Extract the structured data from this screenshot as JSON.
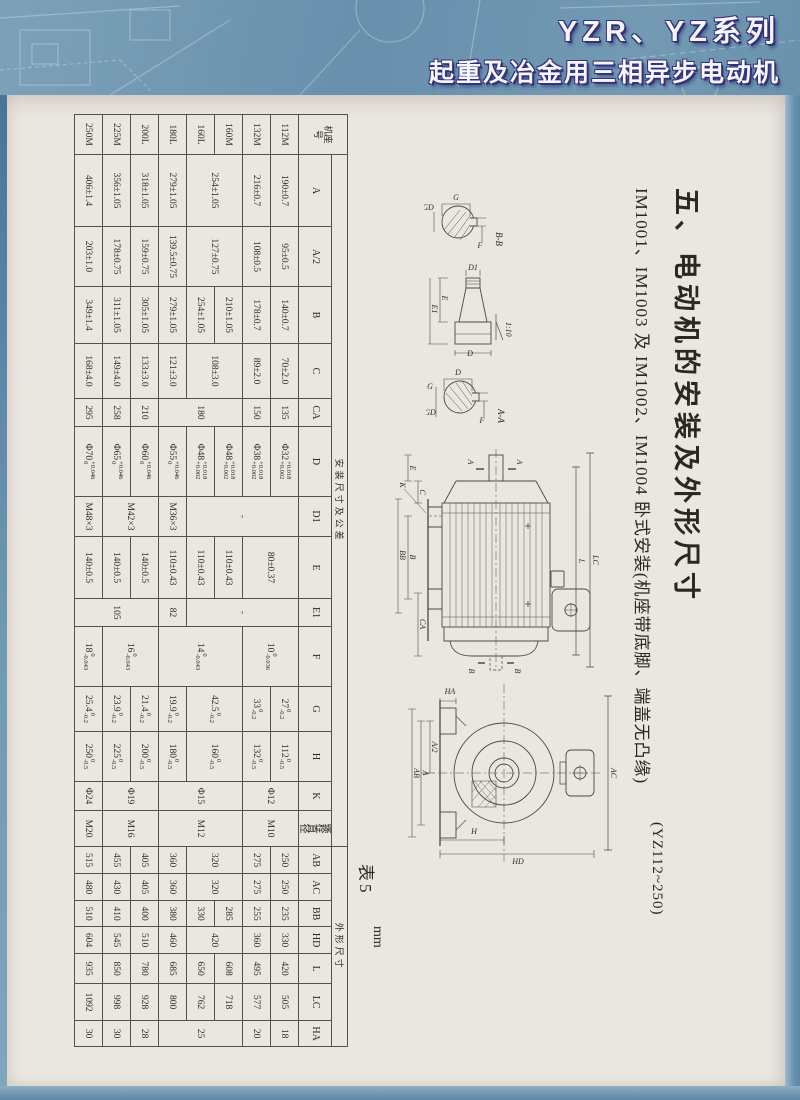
{
  "header": {
    "line1": "YZR、YZ系列",
    "line2": "起重及冶金用三相异步电动机"
  },
  "section": {
    "title": "五、电动机的安装及外形尺寸",
    "subtitle": "IM1001、IM1003 及 IM1002、IM1004 卧式安装(机座带底脚、端盖无凸缘)",
    "note": "(YZ112~250)"
  },
  "table": {
    "caption": "表5",
    "unit": "mm",
    "corner": "机座号",
    "groups": [
      {
        "label": "安装尺寸及公差",
        "span": 14
      },
      {
        "label": "外形尺寸",
        "span": 7
      }
    ],
    "columns": [
      "A",
      "A/2",
      "B",
      "C",
      "CA",
      "D",
      "D1",
      "E",
      "E1",
      "F",
      "G",
      "H",
      "K",
      "螺栓直径",
      "AB",
      "AC",
      "BB",
      "HD",
      "L",
      "LC",
      "HA"
    ],
    "rows": [
      {
        "frame": "112M",
        "cells": [
          {
            "v": "190±0.7"
          },
          {
            "v": "95±0.5"
          },
          {
            "v": "140±0.7"
          },
          {
            "v": "70±2.0"
          },
          {
            "v": "135"
          },
          {
            "v": "Φ32",
            "tt": "+0.018",
            "tb": "+0.002"
          },
          {
            "v": "-",
            "rs": 4
          },
          {
            "v": "80±0.37",
            "rs": 2
          },
          {
            "v": "-",
            "rs": 4
          },
          {
            "v": "10",
            "tt": "0",
            "tb": "-0.036",
            "rs": 2
          },
          {
            "v": "27",
            "tt": "0",
            "tb": "-0.2"
          },
          {
            "v": "112",
            "tt": "0",
            "tb": "-0.5"
          },
          {
            "v": "Φ12",
            "rs": 2
          },
          {
            "v": "M10",
            "rs": 2
          },
          {
            "v": "250"
          },
          {
            "v": "250"
          },
          {
            "v": "235"
          },
          {
            "v": "330"
          },
          {
            "v": "420"
          },
          {
            "v": "505"
          },
          {
            "v": "18"
          }
        ]
      },
      {
        "frame": "132M",
        "cells": [
          {
            "v": "216±0.7"
          },
          {
            "v": "108±0.5"
          },
          {
            "v": "178±0.7"
          },
          {
            "v": "89±2.0"
          },
          {
            "v": "150"
          },
          {
            "v": "Φ38",
            "tt": "+0.018",
            "tb": "+0.002"
          },
          {
            "v": "33",
            "tt": "0",
            "tb": "-0.2"
          },
          {
            "v": "132",
            "tt": "0",
            "tb": "-0.5"
          },
          {
            "v": "275"
          },
          {
            "v": "275"
          },
          {
            "v": "255"
          },
          {
            "v": "360"
          },
          {
            "v": "495"
          },
          {
            "v": "577"
          },
          {
            "v": "20"
          }
        ]
      },
      {
        "frame": "160M",
        "cells": [
          {
            "v": "254±1.05",
            "rs": 2
          },
          {
            "v": "127±0.75",
            "rs": 2
          },
          {
            "v": "210±1.05"
          },
          {
            "v": "108±3.0",
            "rs": 2
          },
          {
            "v": "180",
            "rs": 3
          },
          {
            "v": "Φ48",
            "tt": "+0.018",
            "tb": "+0.002"
          },
          {
            "v": "110±0.43"
          },
          {
            "v": "14",
            "tt": "0",
            "tb": "-0.043",
            "rs": 3
          },
          {
            "v": "42.5",
            "tt": "0",
            "tb": "-0.2",
            "rs": 2
          },
          {
            "v": "160",
            "tt": "0",
            "tb": "-0.5",
            "rs": 2
          },
          {
            "v": "Φ15",
            "rs": 3
          },
          {
            "v": "M12",
            "rs": 3
          },
          {
            "v": "320",
            "rs": 2
          },
          {
            "v": "320",
            "rs": 2
          },
          {
            "v": "285"
          },
          {
            "v": "420",
            "rs": 2
          },
          {
            "v": "608"
          },
          {
            "v": "718"
          },
          {
            "v": "25",
            "rs": 3
          }
        ]
      },
      {
        "frame": "160L",
        "cells": [
          {
            "v": "254±1.05"
          },
          {
            "v": "Φ48",
            "tt": "+0.018",
            "tb": "+0.002"
          },
          {
            "v": "110±0.43"
          },
          {
            "v": "330"
          },
          {
            "v": "650"
          },
          {
            "v": "762"
          }
        ]
      },
      {
        "frame": "180L",
        "cells": [
          {
            "v": "279±1.05"
          },
          {
            "v": "139.5±0.75"
          },
          {
            "v": "279±1.05"
          },
          {
            "v": "121±3.0"
          },
          {
            "v": "Φ55",
            "tt": "+0.046",
            "tb": "0"
          },
          {
            "v": "M36×3"
          },
          {
            "v": "110±0.43"
          },
          {
            "v": "82"
          },
          {
            "v": "19.9",
            "tt": "0",
            "tb": "-0.2"
          },
          {
            "v": "180",
            "tt": "0",
            "tb": "-0.5"
          },
          {
            "v": "360"
          },
          {
            "v": "360"
          },
          {
            "v": "380"
          },
          {
            "v": "460"
          },
          {
            "v": "685"
          },
          {
            "v": "800"
          }
        ]
      },
      {
        "frame": "200L",
        "cells": [
          {
            "v": "318±1.05"
          },
          {
            "v": "159±0.75"
          },
          {
            "v": "305±1.05"
          },
          {
            "v": "133±3.0"
          },
          {
            "v": "210"
          },
          {
            "v": "Φ60",
            "tt": "+0.046",
            "tb": "0"
          },
          {
            "v": "M42×3",
            "rs": 2
          },
          {
            "v": "140±0.5"
          },
          {
            "v": "105",
            "rs": 3
          },
          {
            "v": "16",
            "tt": "0",
            "tb": "-0.043",
            "rs": 2
          },
          {
            "v": "21.4",
            "tt": "0",
            "tb": "-0.2"
          },
          {
            "v": "200",
            "tt": "0",
            "tb": "-0.5"
          },
          {
            "v": "Φ19",
            "rs": 2
          },
          {
            "v": "M16",
            "rs": 2
          },
          {
            "v": "405"
          },
          {
            "v": "405"
          },
          {
            "v": "400"
          },
          {
            "v": "510"
          },
          {
            "v": "780"
          },
          {
            "v": "928"
          },
          {
            "v": "28"
          }
        ]
      },
      {
        "frame": "225M",
        "cells": [
          {
            "v": "356±1.05"
          },
          {
            "v": "178±0.75"
          },
          {
            "v": "311±1.05"
          },
          {
            "v": "149±4.0"
          },
          {
            "v": "258"
          },
          {
            "v": "Φ65",
            "tt": "+0.046",
            "tb": "0"
          },
          {
            "v": "140±0.5"
          },
          {
            "v": "23.9",
            "tt": "0",
            "tb": "-0.2"
          },
          {
            "v": "225",
            "tt": "0",
            "tb": "-0.5"
          },
          {
            "v": "455"
          },
          {
            "v": "430"
          },
          {
            "v": "410"
          },
          {
            "v": "545"
          },
          {
            "v": "850"
          },
          {
            "v": "998"
          },
          {
            "v": "30"
          }
        ]
      },
      {
        "frame": "250M",
        "cells": [
          {
            "v": "406±1.4"
          },
          {
            "v": "203±1.0"
          },
          {
            "v": "349±1.4"
          },
          {
            "v": "168±4.0"
          },
          {
            "v": "295"
          },
          {
            "v": "Φ70",
            "tt": "+0.046",
            "tb": "0"
          },
          {
            "v": "M48×3"
          },
          {
            "v": "140±0.5"
          },
          {
            "v": "18",
            "tt": "0",
            "tb": "-0.043"
          },
          {
            "v": "25.4",
            "tt": "0",
            "tb": "-0.2"
          },
          {
            "v": "250",
            "tt": "0",
            "tb": "-0.5"
          },
          {
            "v": "Φ24"
          },
          {
            "v": "M20"
          },
          {
            "v": "515"
          },
          {
            "v": "480"
          },
          {
            "v": "510"
          },
          {
            "v": "604"
          },
          {
            "v": "935"
          },
          {
            "v": "1092"
          },
          {
            "v": "30"
          }
        ]
      }
    ]
  },
  "drawings": {
    "section_bb": "B-B",
    "section_aa": "A-A",
    "taper_ratio": "1:10",
    "labels": {
      "a": "A",
      "b": "B",
      "c": "C",
      "k": "K",
      "bb": "BB",
      "ca": "CA",
      "e": "E",
      "e1": "E1",
      "l": "L",
      "lc": "LC",
      "d": "D",
      "d1": "D1",
      "g": "G",
      "gd": "GD",
      "f": "F",
      "ha": "HA",
      "a2": "A/2",
      "ab": "AB",
      "ac": "AC",
      "h": "H",
      "hd": "HD"
    }
  },
  "colors": {
    "cover_blue": "#6890ad",
    "title_text": "#f7f5ff",
    "title_shadow": "#32327a",
    "paper": "#eae6e0",
    "ink": "#2e2a24"
  }
}
